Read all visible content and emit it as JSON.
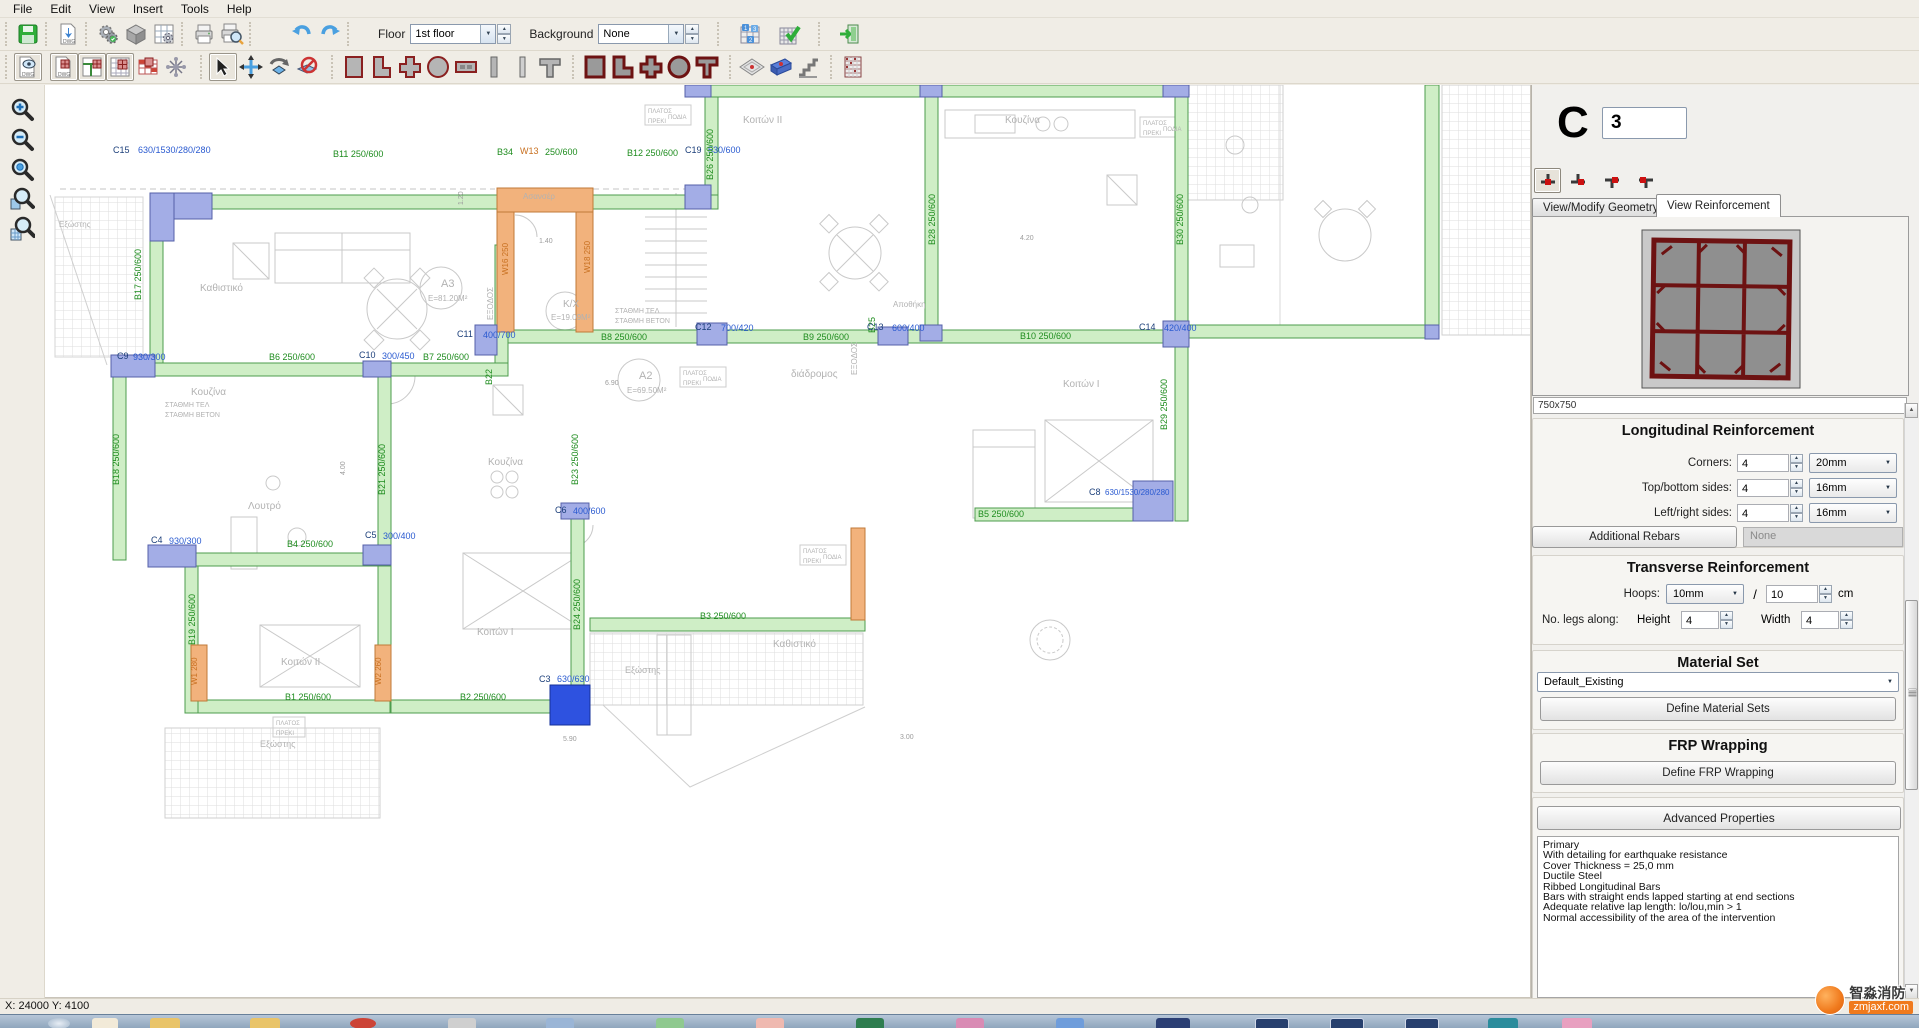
{
  "menu": {
    "items": [
      "File",
      "Edit",
      "View",
      "Insert",
      "Tools",
      "Help"
    ]
  },
  "toolbars": {
    "floor": {
      "label": "Floor",
      "value": "1st floor"
    },
    "background": {
      "label": "Background",
      "value": "None"
    },
    "top_icons": [
      "save",
      "export-dwg",
      "settings",
      "solid-view",
      "grid-settings",
      "print",
      "print-preview",
      "undo",
      "redo",
      "storey-manager",
      "apply-check",
      "exit"
    ],
    "draw_icons": [
      "dwg-view",
      "dwg-columns",
      "plan-view",
      "plan-grid",
      "columns-red",
      "axes",
      "select",
      "move",
      "rotate",
      "cancel",
      "column-rect",
      "column-l",
      "column-plus",
      "column-circle",
      "wall-section",
      "bar",
      "bar2",
      "column-tee",
      "filled-rect",
      "filled-l",
      "filled-plus",
      "filled-circle",
      "filled-tee",
      "slab",
      "beam",
      "stairs",
      "building"
    ],
    "zoom_tools": [
      "zoom-in",
      "zoom-out",
      "zoom-previous",
      "zoom-window",
      "zoom-extents"
    ]
  },
  "plan": {
    "label_colors": {
      "G": "#1e8c1e",
      "B": "#2a5ad0",
      "T": "#1c3f7a",
      "O": "#c87020",
      "Y": "#b2b2b2",
      "D": "#9c9c9c"
    },
    "labels": [
      {
        "t": "C15",
        "x": 68,
        "y": 68,
        "c": "T"
      },
      {
        "t": "630/1530/280/280",
        "x": 93,
        "y": 68,
        "c": "B"
      },
      {
        "t": "B11  250/600",
        "x": 288,
        "y": 72,
        "c": "G"
      },
      {
        "t": "B34",
        "x": 452,
        "y": 70,
        "c": "G"
      },
      {
        "t": "W13",
        "x": 475,
        "y": 69,
        "c": "O"
      },
      {
        "t": "250/600",
        "x": 500,
        "y": 70,
        "c": "G"
      },
      {
        "t": "B12  250/600",
        "x": 582,
        "y": 71,
        "c": "G"
      },
      {
        "t": "C19",
        "x": 640,
        "y": 68,
        "c": "T"
      },
      {
        "t": "530/600",
        "x": 663,
        "y": 68,
        "c": "B"
      },
      {
        "t": "B26  250/600",
        "x": 668,
        "y": 95,
        "c": "G",
        "r": -90
      },
      {
        "t": "Κοιτών II",
        "x": 698,
        "y": 38,
        "c": "Y",
        "s": 10
      },
      {
        "t": "Κουζίνα",
        "x": 960,
        "y": 38,
        "c": "Y",
        "s": 10
      },
      {
        "t": "B28  250/600",
        "x": 890,
        "y": 160,
        "c": "G",
        "r": -90
      },
      {
        "t": "B30  250/600",
        "x": 1138,
        "y": 160,
        "c": "G",
        "r": -90
      },
      {
        "t": "B25",
        "x": 830,
        "y": 248,
        "c": "G",
        "r": -90
      },
      {
        "t": "Αποθήκη",
        "x": 848,
        "y": 222,
        "c": "Y",
        "s": 8
      },
      {
        "t": "B17  250/600",
        "x": 96,
        "y": 215,
        "c": "G",
        "r": -90
      },
      {
        "t": "Καθιστικό",
        "x": 155,
        "y": 206,
        "c": "Y",
        "s": 10
      },
      {
        "t": "Ασανσέρ",
        "x": 478,
        "y": 114,
        "c": "Y",
        "s": 8
      },
      {
        "t": "W16 250",
        "x": 463,
        "y": 190,
        "c": "O",
        "r": -90,
        "s": 8
      },
      {
        "t": "W18 250",
        "x": 545,
        "y": 188,
        "c": "O",
        "r": -90,
        "s": 8
      },
      {
        "t": "ΕΞΟΔΟΣ",
        "x": 448,
        "y": 235,
        "c": "Y",
        "r": -90,
        "s": 8
      },
      {
        "t": "K/X",
        "x": 518,
        "y": 222,
        "c": "Y",
        "s": 10
      },
      {
        "t": "E=19.09M²",
        "x": 506,
        "y": 235,
        "c": "Y",
        "s": 8
      },
      {
        "t": "ΣΤΑΘΜΗ ΤΕΛ",
        "x": 570,
        "y": 228,
        "c": "Y",
        "s": 7
      },
      {
        "t": "ΣΤΑΘΜΗ ΒΕΤΟΝ",
        "x": 570,
        "y": 238,
        "c": "Y",
        "s": 7
      },
      {
        "t": "ΣΤΑΘΜΗ ΤΕΛ",
        "x": 120,
        "y": 322,
        "c": "Y",
        "s": 7
      },
      {
        "t": "ΣΤΑΘΜΗ ΒΕΤΟΝ",
        "x": 120,
        "y": 332,
        "c": "Y",
        "s": 7
      },
      {
        "t": "A3",
        "x": 396,
        "y": 202,
        "c": "Y",
        "s": 11
      },
      {
        "t": "E=81.20M²",
        "x": 383,
        "y": 216,
        "c": "Y",
        "s": 8
      },
      {
        "t": "C11",
        "x": 412,
        "y": 252,
        "c": "T"
      },
      {
        "t": "400/700",
        "x": 438,
        "y": 253,
        "c": "B"
      },
      {
        "t": "B8  250/600",
        "x": 556,
        "y": 255,
        "c": "G"
      },
      {
        "t": "C12",
        "x": 650,
        "y": 245,
        "c": "T"
      },
      {
        "t": "700/420",
        "x": 676,
        "y": 246,
        "c": "B"
      },
      {
        "t": "B9  250/600",
        "x": 758,
        "y": 255,
        "c": "G"
      },
      {
        "t": "C13",
        "x": 822,
        "y": 245,
        "c": "T"
      },
      {
        "t": "600/400",
        "x": 847,
        "y": 246,
        "c": "B"
      },
      {
        "t": "B10  250/600",
        "x": 975,
        "y": 254,
        "c": "G"
      },
      {
        "t": "C14",
        "x": 1094,
        "y": 245,
        "c": "T"
      },
      {
        "t": "420/400",
        "x": 1119,
        "y": 246,
        "c": "B"
      },
      {
        "t": "ΕΞΟΔΟΣ",
        "x": 812,
        "y": 290,
        "c": "Y",
        "r": -90,
        "s": 8
      },
      {
        "t": "C9",
        "x": 72,
        "y": 274,
        "c": "T"
      },
      {
        "t": "930/300",
        "x": 88,
        "y": 275,
        "c": "B"
      },
      {
        "t": "B6  250/600",
        "x": 224,
        "y": 275,
        "c": "G"
      },
      {
        "t": "C10",
        "x": 314,
        "y": 273,
        "c": "T"
      },
      {
        "t": "300/450",
        "x": 337,
        "y": 274,
        "c": "B"
      },
      {
        "t": "B7  250/600",
        "x": 378,
        "y": 275,
        "c": "G"
      },
      {
        "t": "B22",
        "x": 447,
        "y": 300,
        "c": "G",
        "r": -90
      },
      {
        "t": "Κουζίνα",
        "x": 146,
        "y": 310,
        "c": "Y",
        "s": 10
      },
      {
        "t": "A2",
        "x": 594,
        "y": 294,
        "c": "Y",
        "s": 11
      },
      {
        "t": "E=69.50M²",
        "x": 582,
        "y": 308,
        "c": "Y",
        "s": 8
      },
      {
        "t": "διάδρομος",
        "x": 746,
        "y": 292,
        "c": "Y",
        "s": 10
      },
      {
        "t": "Κοιτών I",
        "x": 1018,
        "y": 302,
        "c": "Y",
        "s": 10
      },
      {
        "t": "B18  250/600",
        "x": 74,
        "y": 400,
        "c": "G",
        "r": -90
      },
      {
        "t": "Λουτρό",
        "x": 203,
        "y": 424,
        "c": "Y",
        "s": 10
      },
      {
        "t": "B21  250/600",
        "x": 340,
        "y": 410,
        "c": "G",
        "r": -90
      },
      {
        "t": "Κουζίνα",
        "x": 443,
        "y": 380,
        "c": "Y",
        "s": 10
      },
      {
        "t": "B23  250/600",
        "x": 533,
        "y": 400,
        "c": "G",
        "r": -90
      },
      {
        "t": "C6",
        "x": 510,
        "y": 428,
        "c": "T"
      },
      {
        "t": "400/600",
        "x": 528,
        "y": 429,
        "c": "B"
      },
      {
        "t": "B5  250/600",
        "x": 933,
        "y": 432,
        "c": "G"
      },
      {
        "t": "C8",
        "x": 1044,
        "y": 410,
        "c": "T"
      },
      {
        "t": "630/1530/280/280",
        "x": 1060,
        "y": 410,
        "c": "B",
        "s": 8
      },
      {
        "t": "B29  250/600",
        "x": 1122,
        "y": 345,
        "c": "G",
        "r": -90
      },
      {
        "t": "C4",
        "x": 106,
        "y": 458,
        "c": "T"
      },
      {
        "t": "930/300",
        "x": 124,
        "y": 459,
        "c": "B"
      },
      {
        "t": "B4  250/600",
        "x": 242,
        "y": 462,
        "c": "G"
      },
      {
        "t": "C5",
        "x": 320,
        "y": 453,
        "c": "T"
      },
      {
        "t": "300/400",
        "x": 338,
        "y": 454,
        "c": "B"
      },
      {
        "t": "B19  250/600",
        "x": 150,
        "y": 560,
        "c": "G",
        "r": -90
      },
      {
        "t": "W1 280",
        "x": 152,
        "y": 600,
        "c": "O",
        "r": -90,
        "s": 8
      },
      {
        "t": "B1  250/600",
        "x": 240,
        "y": 615,
        "c": "G"
      },
      {
        "t": "W2 260",
        "x": 336,
        "y": 600,
        "c": "O",
        "r": -90,
        "s": 8
      },
      {
        "t": "B2  250/600",
        "x": 415,
        "y": 615,
        "c": "G"
      },
      {
        "t": "C3",
        "x": 494,
        "y": 597,
        "c": "T"
      },
      {
        "t": "630/630",
        "x": 512,
        "y": 597,
        "c": "B"
      },
      {
        "t": "B24  250/600",
        "x": 535,
        "y": 545,
        "c": "G",
        "r": -90
      },
      {
        "t": "B3  250/600",
        "x": 655,
        "y": 534,
        "c": "G"
      },
      {
        "t": "Κοιτών II",
        "x": 236,
        "y": 580,
        "c": "Y",
        "s": 10
      },
      {
        "t": "Κοιτών I",
        "x": 432,
        "y": 550,
        "c": "Y",
        "s": 10
      },
      {
        "t": "Καθιστικό",
        "x": 728,
        "y": 562,
        "c": "Y",
        "s": 10
      },
      {
        "t": "Εξώστης",
        "x": 215,
        "y": 662,
        "c": "Y",
        "s": 9
      },
      {
        "t": "Εξώστης",
        "x": 580,
        "y": 588,
        "c": "Y",
        "s": 9
      },
      {
        "t": "Εξώστης",
        "x": 14,
        "y": 142,
        "c": "Y",
        "s": 8
      },
      {
        "t": "ΠΛΑΤΟΣ",
        "x": 603,
        "y": 28,
        "c": "Y",
        "s": 6
      },
      {
        "t": "ΠΟΔΙΑ",
        "x": 623,
        "y": 34,
        "c": "Y",
        "s": 6
      },
      {
        "t": "ΠΡΕΚΙ",
        "x": 603,
        "y": 38,
        "c": "Y",
        "s": 6
      },
      {
        "t": "ΠΛΑΤΟΣ",
        "x": 1098,
        "y": 40,
        "c": "Y",
        "s": 6
      },
      {
        "t": "ΠΟΔΙΑ",
        "x": 1118,
        "y": 46,
        "c": "Y",
        "s": 6
      },
      {
        "t": "ΠΡΕΚΙ",
        "x": 1098,
        "y": 50,
        "c": "Y",
        "s": 6
      },
      {
        "t": "ΠΛΑΤΟΣ",
        "x": 638,
        "y": 290,
        "c": "Y",
        "s": 6
      },
      {
        "t": "ΠΟΔΙΑ",
        "x": 658,
        "y": 296,
        "c": "Y",
        "s": 6
      },
      {
        "t": "ΠΡΕΚΙ",
        "x": 638,
        "y": 300,
        "c": "Y",
        "s": 6
      },
      {
        "t": "ΠΛΑΤΟΣ",
        "x": 758,
        "y": 468,
        "c": "Y",
        "s": 6
      },
      {
        "t": "ΠΟΔΙΑ",
        "x": 778,
        "y": 474,
        "c": "Y",
        "s": 6
      },
      {
        "t": "ΠΡΕΚΙ",
        "x": 758,
        "y": 478,
        "c": "Y",
        "s": 6
      },
      {
        "t": "ΠΛΑΤΟΣ",
        "x": 231,
        "y": 640,
        "c": "Y",
        "s": 6
      },
      {
        "t": "ΠΡΕΚΙ",
        "x": 231,
        "y": 650,
        "c": "Y",
        "s": 6
      },
      {
        "t": "4.20",
        "x": 975,
        "y": 155,
        "c": "D",
        "s": 7
      },
      {
        "t": "6.90",
        "x": 560,
        "y": 300,
        "c": "D",
        "s": 7
      },
      {
        "t": "5.90",
        "x": 518,
        "y": 656,
        "c": "D",
        "s": 7
      },
      {
        "t": "3.00",
        "x": 855,
        "y": 654,
        "c": "D",
        "s": 7
      },
      {
        "t": "1.40",
        "x": 494,
        "y": 158,
        "c": "D",
        "s": 7
      },
      {
        "t": "1.20",
        "x": 418,
        "y": 120,
        "c": "D",
        "s": 7,
        "r": -90
      },
      {
        "t": "4.00",
        "x": 300,
        "y": 390,
        "c": "D",
        "s": 7,
        "r": -90
      }
    ]
  },
  "panel": {
    "column_letter": "C",
    "column_number": "3",
    "position_icons": [
      "position-bottom-left",
      "position-bottom-right",
      "position-top-right",
      "position-top-left"
    ],
    "tabs": [
      {
        "label": "View/Modify Geometry"
      },
      {
        "label": "View Reinforcement"
      }
    ],
    "section_size": "750x750",
    "longitudinal": {
      "title": "Longitudinal Reinforcement",
      "rows": [
        {
          "label": "Corners:",
          "count": "4",
          "diameter": "20mm"
        },
        {
          "label": "Top/bottom sides:",
          "count": "4",
          "diameter": "16mm"
        },
        {
          "label": "Left/right sides:",
          "count": "4",
          "diameter": "16mm"
        }
      ],
      "additional_button": "Additional Rebars",
      "additional_value": "None"
    },
    "transverse": {
      "title": "Transverse Reinforcement",
      "hoops_label": "Hoops:",
      "hoop_diameter": "10mm",
      "slash": "/",
      "spacing": "10",
      "unit": "cm",
      "legs_label": "No. legs along:",
      "height_label": "Height",
      "height": "4",
      "width_label": "Width",
      "width": "4"
    },
    "material": {
      "title": "Material Set",
      "selected": "Default_Existing",
      "button": "Define Material Sets"
    },
    "frp": {
      "title": "FRP Wrapping",
      "button": "Define FRP Wrapping"
    },
    "advanced": {
      "title": "Advanced Properties",
      "lines": [
        "Primary",
        "With detailing for earthquake resistance",
        "Cover Thickness = 25,0 mm",
        "Ductile Steel",
        "Ribbed Longitudinal Bars",
        "Bars with straight ends lapped starting at end sections",
        "Adequate relative lap length: lo/lou,min > 1",
        "Normal accessibility of the area of the intervention"
      ]
    }
  },
  "statusbar": {
    "coordinates": "X: 24000  Y: 4100"
  },
  "watermark": {
    "name_cn": "智淼消防",
    "site": "zmjaxf.com"
  },
  "colors": {
    "beam_fill": "#cfeec6",
    "beam_border": "#4d9c4d",
    "column_fill": "#a3ade6",
    "column_border": "#5560a8",
    "selected_column": "#2e52e0",
    "wall_fill": "#f2b27c",
    "wall_border": "#c07a38",
    "rebar": "#6d1212"
  }
}
